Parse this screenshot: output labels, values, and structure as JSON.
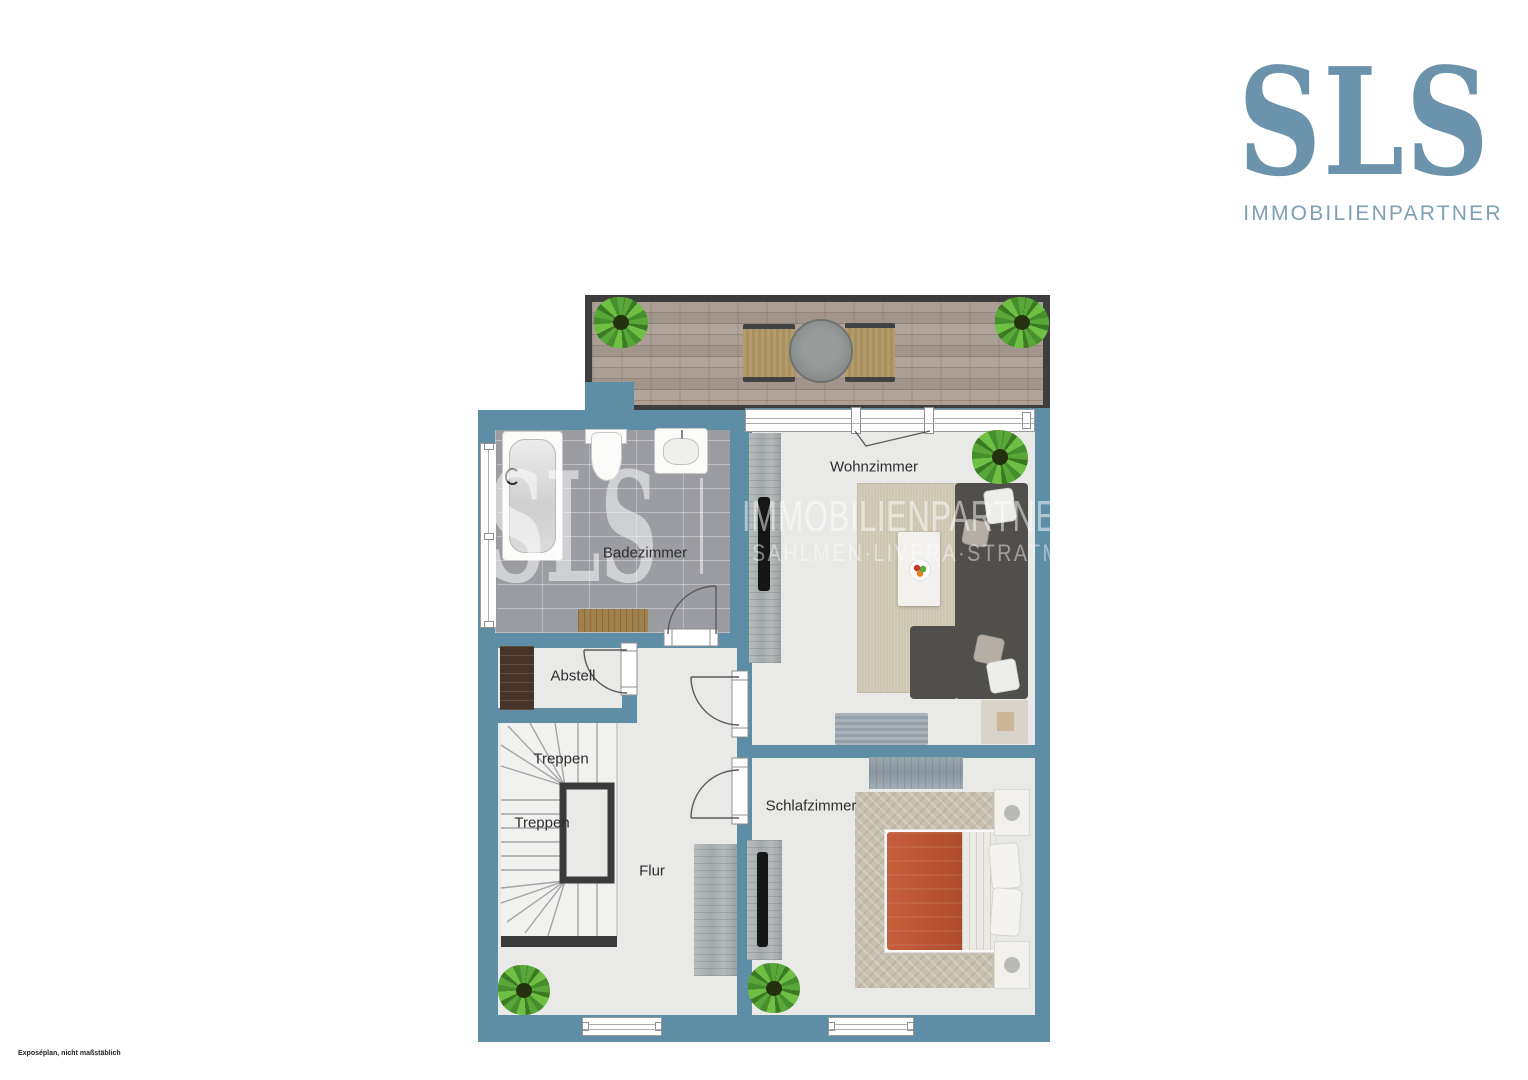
{
  "brand": {
    "logo_text": "SLS",
    "logo_subtext": "IMMOBILIENPARTNER"
  },
  "watermark": {
    "logo_text": "SLS",
    "partner_text": "IMMOBILIENPARTNER",
    "names_text": "SAHLMEN·LIVERA·STRATMANN"
  },
  "plan": {
    "rooms": [
      {
        "label": "Badezimmer"
      },
      {
        "label": "Wohnzimmer"
      },
      {
        "label": "Abstell"
      },
      {
        "label": "Treppen"
      },
      {
        "label": "Treppen"
      },
      {
        "label": "Flur"
      },
      {
        "label": "Schlafzimmer"
      }
    ]
  },
  "footer": {
    "disclaimer": "Exposéplan, nicht maßstäblich"
  },
  "colors": {
    "wall": "#5e8da6",
    "floor": "#e9e9e7",
    "bath_tile": "#9c9da3",
    "dark_frame": "#3d3d3d",
    "deck_wood": "#a2958b",
    "logo_blue": "#6b93ab",
    "duvet_orange": "#b5502f",
    "sofa_gray": "#514f4b",
    "plant_green": "#59a738"
  }
}
